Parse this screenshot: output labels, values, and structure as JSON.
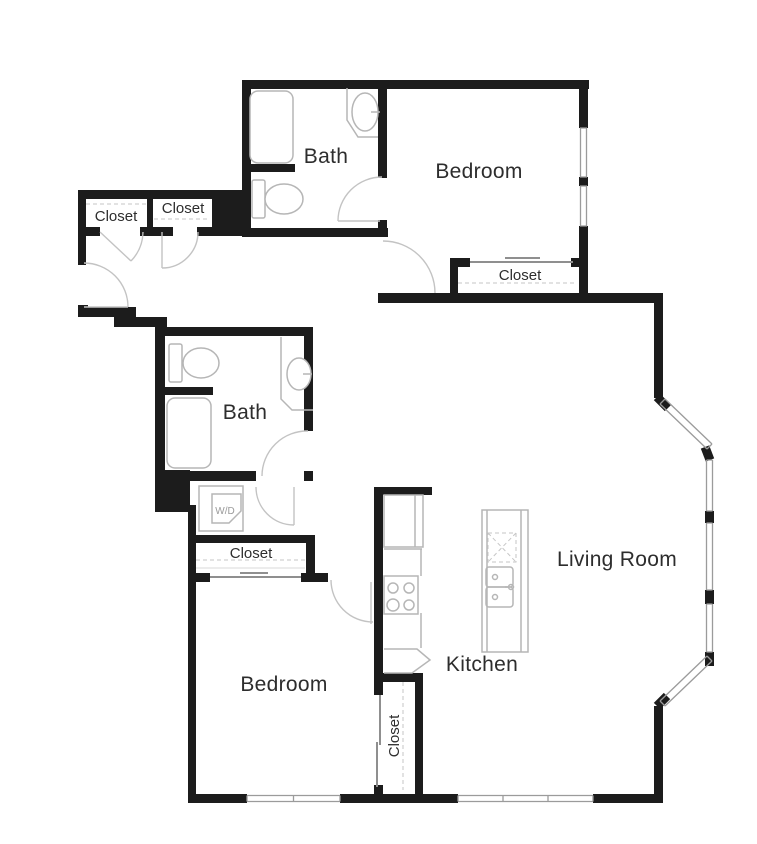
{
  "figure_type": "apartment-floor-plan",
  "colors": {
    "background": "#ffffff",
    "wall": "#1c1c1c",
    "fixture": "#b6b6b6",
    "door": "#c3c3c3",
    "window": "#9b9b9b",
    "slide": "#8f8f8f",
    "dash": "#c6c6c6",
    "text": "#2d2d2d"
  },
  "labels": {
    "bath_upper": "Bath",
    "bedroom_upper": "Bedroom",
    "closet_entry_left": "Closet",
    "closet_entry_right": "Closet",
    "closet_bedroom_upper": "Closet",
    "bath_lower": "Bath",
    "washer_dryer": "W/D",
    "closet_hall": "Closet",
    "bedroom_lower": "Bedroom",
    "kitchen": "Kitchen",
    "living_room": "Living Room",
    "closet_kitchen": "Closet"
  }
}
